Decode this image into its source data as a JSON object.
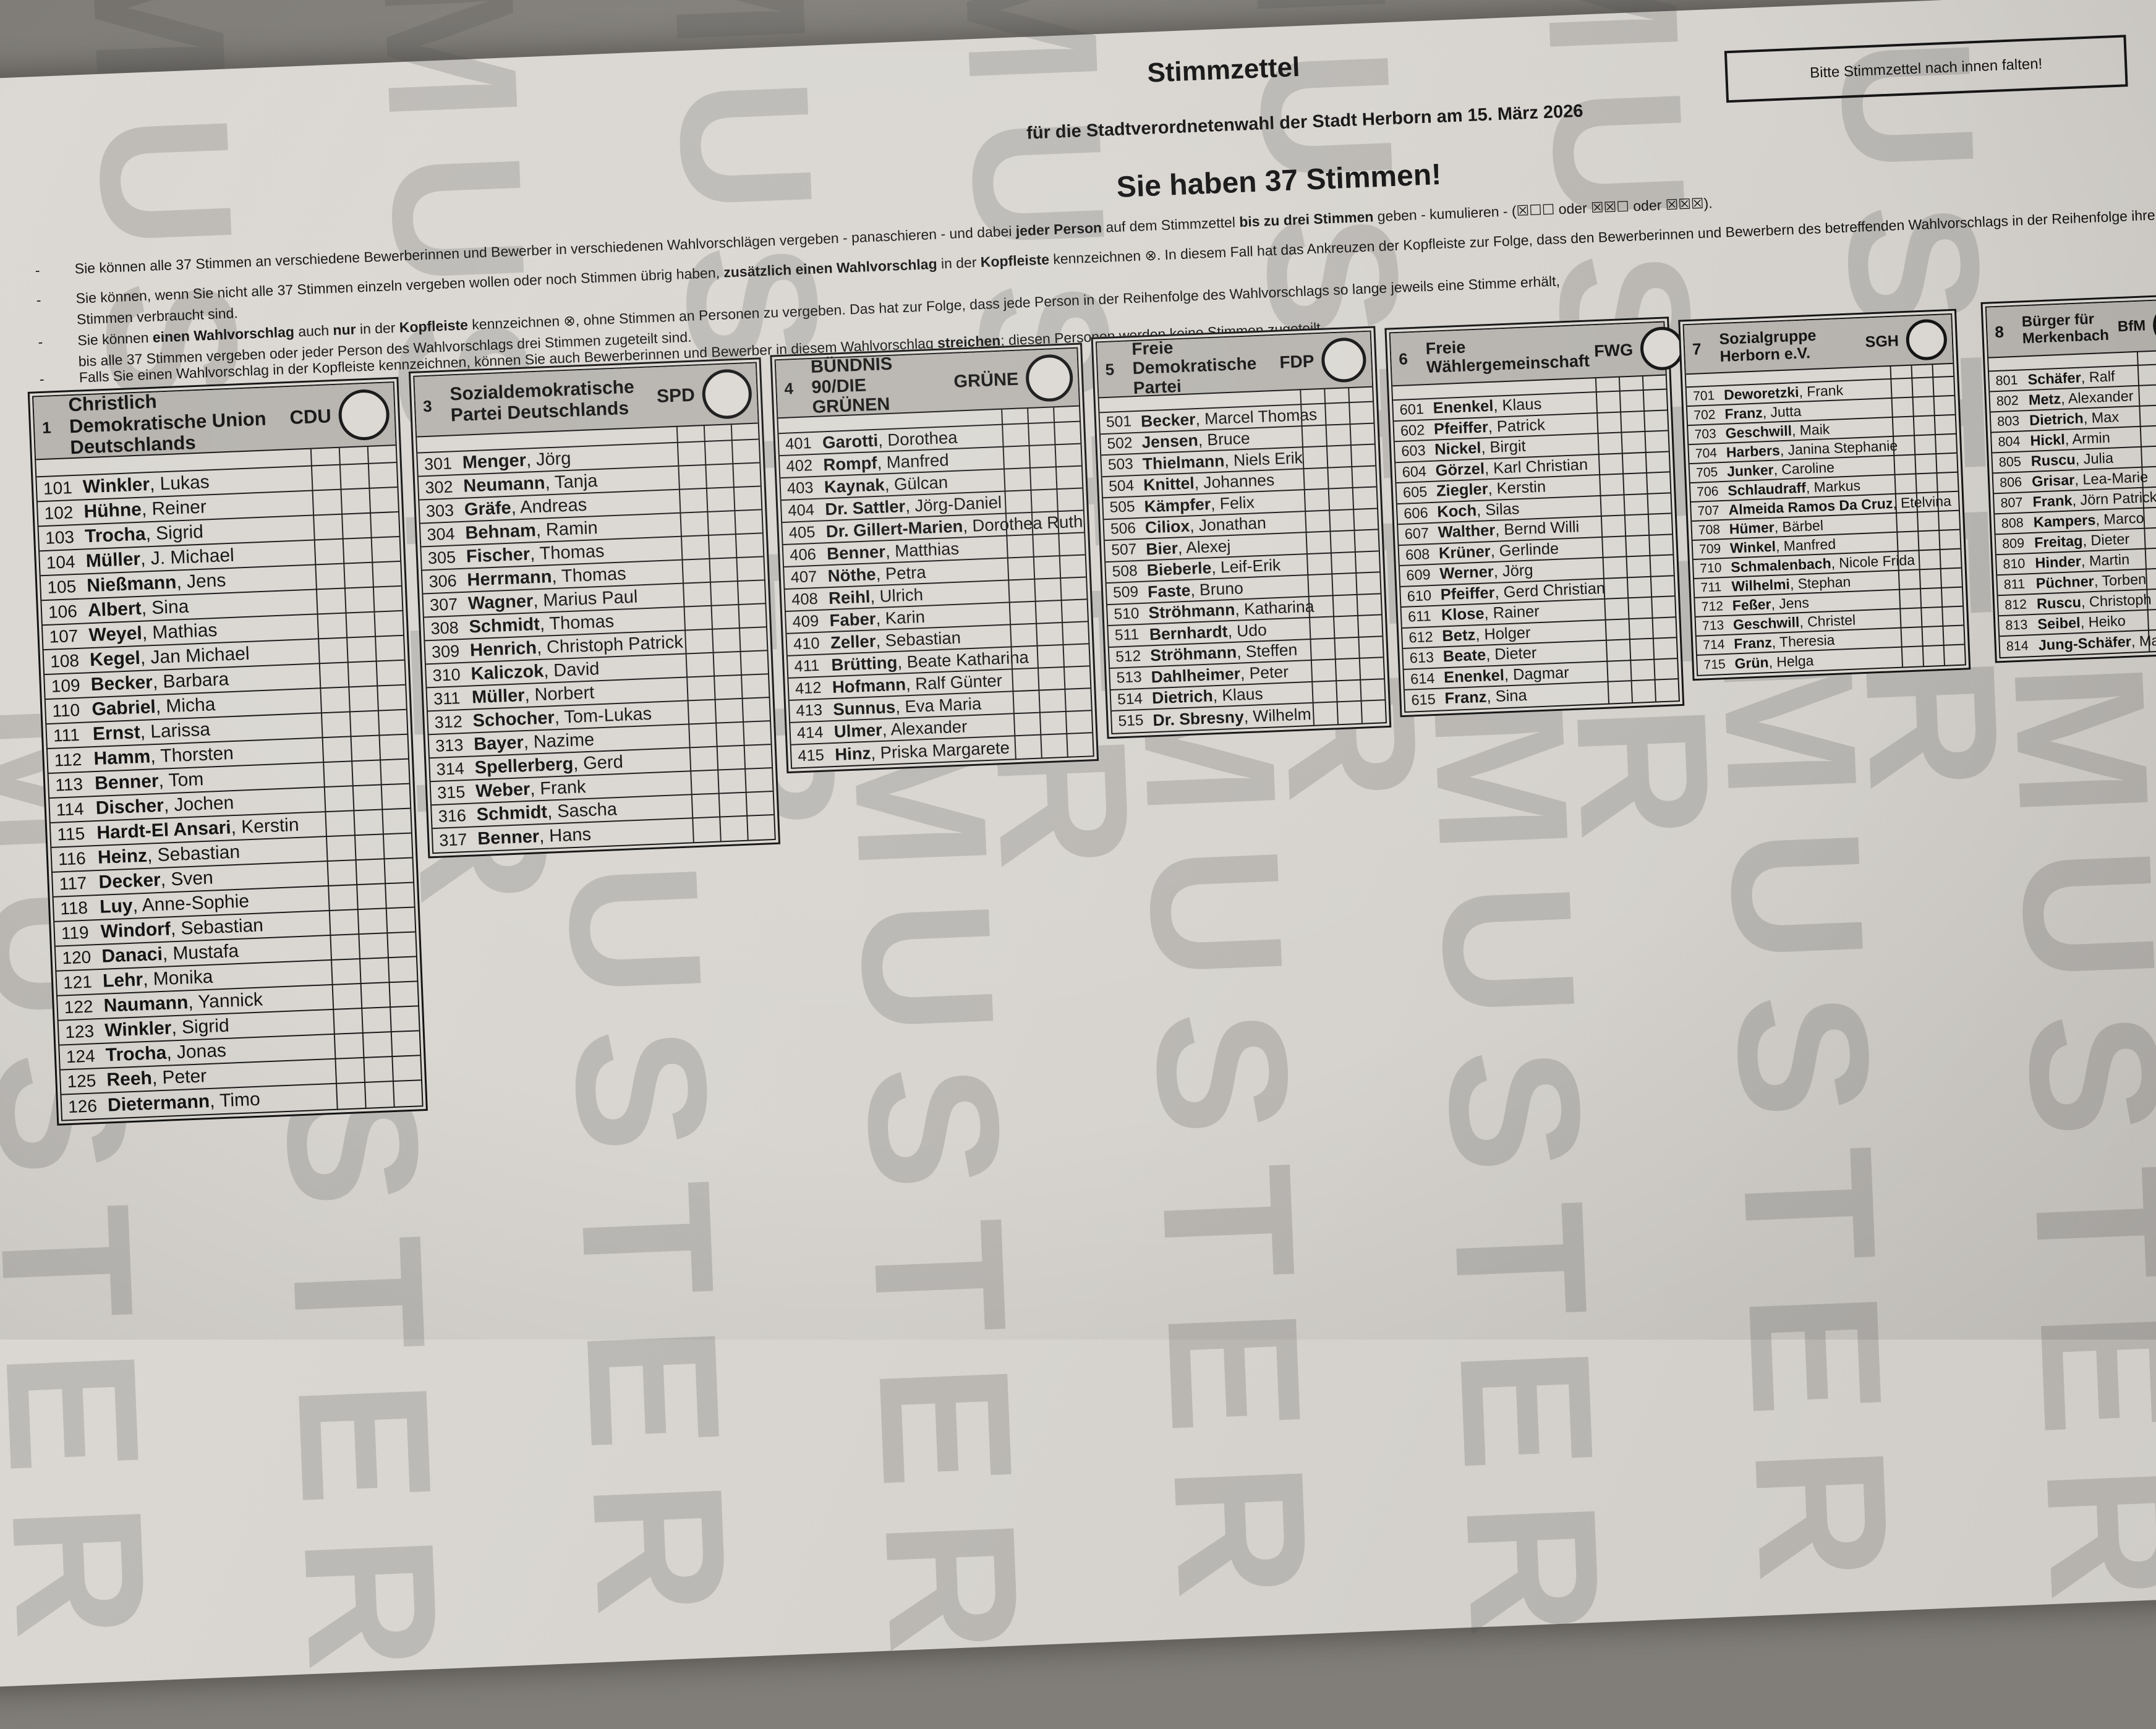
{
  "title": "Stimmzettel",
  "subtitle": "für die Stadtverordnetenwahl der Stadt Herborn am 15. März 2026",
  "votes_headline": "Sie haben 37 Stimmen!",
  "fold_notice": "Bitte Stimmzettel nach innen falten!",
  "watermark": "MUSTER",
  "instructions": [
    [
      {
        "t": "Sie können alle 37 Stimmen an verschiedene Bewerberinnen und Bewerber in verschiedenen Wahlvorschlägen vergeben - panaschieren - und dabei ",
        "b": 0
      },
      {
        "t": "jeder Person",
        "b": 1
      },
      {
        "t": " auf dem Stimmzettel ",
        "b": 0
      },
      {
        "t": "bis zu drei Stimmen",
        "b": 1
      },
      {
        "t": " geben - kumulieren - (☒☐☐ oder ☒☒☐ oder ☒☒☒).",
        "b": 0
      }
    ],
    [
      {
        "t": "Sie können, wenn Sie nicht alle 37 Stimmen einzeln vergeben wollen oder noch Stimmen übrig haben, ",
        "b": 0
      },
      {
        "t": "zusätzlich einen Wahlvorschlag",
        "b": 1
      },
      {
        "t": " in der ",
        "b": 0
      },
      {
        "t": "Kopfleiste",
        "b": 1
      },
      {
        "t": " kennzeichnen ⊗. In diesem Fall hat das Ankreuzen der Kopfleiste zur Folge, dass den Bewerberinnen und Bewerbern des betreffenden Wahlvorschlags in der Reihenfolge ihrer Benennung so lange eine weitere Stimme zugerechnet wird, bis alle\nStimmen verbraucht sind.",
        "b": 0
      }
    ],
    [
      {
        "t": "Sie können ",
        "b": 0
      },
      {
        "t": "einen Wahlvorschlag",
        "b": 1
      },
      {
        "t": " auch ",
        "b": 0
      },
      {
        "t": "nur",
        "b": 1
      },
      {
        "t": " in der ",
        "b": 0
      },
      {
        "t": "Kopfleiste",
        "b": 1
      },
      {
        "t": " kennzeichnen ⊗, ohne Stimmen an Personen zu vergeben. Das hat zur Folge, dass jede Person in der Reihenfolge des Wahlvorschlags so lange jeweils eine Stimme erhält,\nbis alle 37 Stimmen vergeben oder jeder Person des Wahlvorschlags drei Stimmen zugeteilt sind.",
        "b": 0
      }
    ],
    [
      {
        "t": "Falls Sie einen Wahlvorschlag in der Kopfleiste kennzeichnen, können Sie auch Bewerberinnen und Bewerber in diesem Wahlvorschlag ",
        "b": 0
      },
      {
        "t": "streichen",
        "b": 1
      },
      {
        "t": "; diesen Personen werden keine Stimmen zugeteilt.",
        "b": 0
      }
    ]
  ],
  "parties": [
    {
      "number": "1",
      "name": "Christlich Demokratische Union Deutschlands",
      "abbr": "CDU",
      "candidates": [
        {
          "no": "101",
          "last": "Winkler",
          "first": "Lukas"
        },
        {
          "no": "102",
          "last": "Hühne",
          "first": "Reiner"
        },
        {
          "no": "103",
          "last": "Trocha",
          "first": "Sigrid"
        },
        {
          "no": "104",
          "last": "Müller",
          "first": "J. Michael"
        },
        {
          "no": "105",
          "last": "Nießmann",
          "first": "Jens"
        },
        {
          "no": "106",
          "last": "Albert",
          "first": "Sina"
        },
        {
          "no": "107",
          "last": "Weyel",
          "first": "Mathias"
        },
        {
          "no": "108",
          "last": "Kegel",
          "first": "Jan Michael"
        },
        {
          "no": "109",
          "last": "Becker",
          "first": "Barbara"
        },
        {
          "no": "110",
          "last": "Gabriel",
          "first": "Micha"
        },
        {
          "no": "111",
          "last": "Ernst",
          "first": "Larissa"
        },
        {
          "no": "112",
          "last": "Hamm",
          "first": "Thorsten"
        },
        {
          "no": "113",
          "last": "Benner",
          "first": "Tom"
        },
        {
          "no": "114",
          "last": "Discher",
          "first": "Jochen"
        },
        {
          "no": "115",
          "last": "Hardt-El Ansari",
          "first": "Kerstin"
        },
        {
          "no": "116",
          "last": "Heinz",
          "first": "Sebastian"
        },
        {
          "no": "117",
          "last": "Decker",
          "first": "Sven"
        },
        {
          "no": "118",
          "last": "Luy",
          "first": "Anne-Sophie"
        },
        {
          "no": "119",
          "last": "Windorf",
          "first": "Sebastian"
        },
        {
          "no": "120",
          "last": "Danaci",
          "first": "Mustafa"
        },
        {
          "no": "121",
          "last": "Lehr",
          "first": "Monika"
        },
        {
          "no": "122",
          "last": "Naumann",
          "first": "Yannick"
        },
        {
          "no": "123",
          "last": "Winkler",
          "first": "Sigrid"
        },
        {
          "no": "124",
          "last": "Trocha",
          "first": "Jonas"
        },
        {
          "no": "125",
          "last": "Reeh",
          "first": "Peter"
        },
        {
          "no": "126",
          "last": "Dietermann",
          "first": "Timo"
        }
      ]
    },
    {
      "number": "3",
      "name": "Sozialdemokratische Partei Deutschlands",
      "abbr": "SPD",
      "candidates": [
        {
          "no": "301",
          "last": "Menger",
          "first": "Jörg"
        },
        {
          "no": "302",
          "last": "Neumann",
          "first": "Tanja"
        },
        {
          "no": "303",
          "last": "Gräfe",
          "first": "Andreas"
        },
        {
          "no": "304",
          "last": "Behnam",
          "first": "Ramin"
        },
        {
          "no": "305",
          "last": "Fischer",
          "first": "Thomas"
        },
        {
          "no": "306",
          "last": "Herrmann",
          "first": "Thomas"
        },
        {
          "no": "307",
          "last": "Wagner",
          "first": "Marius Paul"
        },
        {
          "no": "308",
          "last": "Schmidt",
          "first": "Thomas"
        },
        {
          "no": "309",
          "last": "Henrich",
          "first": "Christoph Patrick"
        },
        {
          "no": "310",
          "last": "Kaliczok",
          "first": "David"
        },
        {
          "no": "311",
          "last": "Müller",
          "first": "Norbert"
        },
        {
          "no": "312",
          "last": "Schocher",
          "first": "Tom-Lukas"
        },
        {
          "no": "313",
          "last": "Bayer",
          "first": "Nazime"
        },
        {
          "no": "314",
          "last": "Spellerberg",
          "first": "Gerd"
        },
        {
          "no": "315",
          "last": "Weber",
          "first": "Frank"
        },
        {
          "no": "316",
          "last": "Schmidt",
          "first": "Sascha"
        },
        {
          "no": "317",
          "last": "Benner",
          "first": "Hans"
        }
      ]
    },
    {
      "number": "4",
      "name": "BÜNDNIS 90/DIE GRÜNEN",
      "abbr": "GRÜNE",
      "candidates": [
        {
          "no": "401",
          "last": "Garotti",
          "first": "Dorothea"
        },
        {
          "no": "402",
          "last": "Rompf",
          "first": "Manfred"
        },
        {
          "no": "403",
          "last": "Kaynak",
          "first": "Gülcan"
        },
        {
          "no": "404",
          "last": "Dr. Sattler",
          "first": "Jörg-Daniel"
        },
        {
          "no": "405",
          "last": "Dr. Gillert-Marien",
          "first": "Dorothea Ruth"
        },
        {
          "no": "406",
          "last": "Benner",
          "first": "Matthias"
        },
        {
          "no": "407",
          "last": "Nöthe",
          "first": "Petra"
        },
        {
          "no": "408",
          "last": "Reihl",
          "first": "Ulrich"
        },
        {
          "no": "409",
          "last": "Faber",
          "first": "Karin"
        },
        {
          "no": "410",
          "last": "Zeller",
          "first": "Sebastian"
        },
        {
          "no": "411",
          "last": "Brütting",
          "first": "Beate Katharina"
        },
        {
          "no": "412",
          "last": "Hofmann",
          "first": "Ralf Günter"
        },
        {
          "no": "413",
          "last": "Sunnus",
          "first": "Eva Maria"
        },
        {
          "no": "414",
          "last": "Ulmer",
          "first": "Alexander"
        },
        {
          "no": "415",
          "last": "Hinz",
          "first": "Priska Margarete"
        }
      ]
    },
    {
      "number": "5",
      "name": "Freie Demokratische Partei",
      "abbr": "FDP",
      "candidates": [
        {
          "no": "501",
          "last": "Becker",
          "first": "Marcel Thomas"
        },
        {
          "no": "502",
          "last": "Jensen",
          "first": "Bruce"
        },
        {
          "no": "503",
          "last": "Thielmann",
          "first": "Niels Erik"
        },
        {
          "no": "504",
          "last": "Knittel",
          "first": "Johannes"
        },
        {
          "no": "505",
          "last": "Kämpfer",
          "first": "Felix"
        },
        {
          "no": "506",
          "last": "Ciliox",
          "first": "Jonathan"
        },
        {
          "no": "507",
          "last": "Bier",
          "first": "Alexej"
        },
        {
          "no": "508",
          "last": "Bieberle",
          "first": "Leif-Erik"
        },
        {
          "no": "509",
          "last": "Faste",
          "first": "Bruno"
        },
        {
          "no": "510",
          "last": "Ströhmann",
          "first": "Katharina"
        },
        {
          "no": "511",
          "last": "Bernhardt",
          "first": "Udo"
        },
        {
          "no": "512",
          "last": "Ströhmann",
          "first": "Steffen"
        },
        {
          "no": "513",
          "last": "Dahlheimer",
          "first": "Peter"
        },
        {
          "no": "514",
          "last": "Dietrich",
          "first": "Klaus"
        },
        {
          "no": "515",
          "last": "Dr. Sbresny",
          "first": "Wilhelm"
        }
      ]
    },
    {
      "number": "6",
      "name": "Freie Wählergemeinschaft",
      "abbr": "FWG",
      "candidates": [
        {
          "no": "601",
          "last": "Enenkel",
          "first": "Klaus"
        },
        {
          "no": "602",
          "last": "Pfeiffer",
          "first": "Patrick"
        },
        {
          "no": "603",
          "last": "Nickel",
          "first": "Birgit"
        },
        {
          "no": "604",
          "last": "Görzel",
          "first": "Karl Christian"
        },
        {
          "no": "605",
          "last": "Ziegler",
          "first": "Kerstin"
        },
        {
          "no": "606",
          "last": "Koch",
          "first": "Silas"
        },
        {
          "no": "607",
          "last": "Walther",
          "first": "Bernd Willi"
        },
        {
          "no": "608",
          "last": "Krüner",
          "first": "Gerlinde"
        },
        {
          "no": "609",
          "last": "Werner",
          "first": "Jörg"
        },
        {
          "no": "610",
          "last": "Pfeiffer",
          "first": "Gerd Christian"
        },
        {
          "no": "611",
          "last": "Klose",
          "first": "Rainer"
        },
        {
          "no": "612",
          "last": "Betz",
          "first": "Holger"
        },
        {
          "no": "613",
          "last": "Beate",
          "first": "Dieter"
        },
        {
          "no": "614",
          "last": "Enenkel",
          "first": "Dagmar"
        },
        {
          "no": "615",
          "last": "Franz",
          "first": "Sina"
        }
      ]
    },
    {
      "number": "7",
      "name": "Sozialgruppe Herborn e.V.",
      "abbr": "SGH",
      "candidates": [
        {
          "no": "701",
          "last": "Deworetzki",
          "first": "Frank"
        },
        {
          "no": "702",
          "last": "Franz",
          "first": "Jutta"
        },
        {
          "no": "703",
          "last": "Geschwill",
          "first": "Maik"
        },
        {
          "no": "704",
          "last": "Harbers",
          "first": "Janina Stephanie"
        },
        {
          "no": "705",
          "last": "Junker",
          "first": "Caroline"
        },
        {
          "no": "706",
          "last": "Schlaudraff",
          "first": "Markus"
        },
        {
          "no": "707",
          "last": "Almeida Ramos Da Cruz",
          "first": "Etelvina"
        },
        {
          "no": "708",
          "last": "Hümer",
          "first": "Bärbel"
        },
        {
          "no": "709",
          "last": "Winkel",
          "first": "Manfred"
        },
        {
          "no": "710",
          "last": "Schmalenbach",
          "first": "Nicole Frida"
        },
        {
          "no": "711",
          "last": "Wilhelmi",
          "first": "Stephan"
        },
        {
          "no": "712",
          "last": "Feßer",
          "first": "Jens"
        },
        {
          "no": "713",
          "last": "Geschwill",
          "first": "Christel"
        },
        {
          "no": "714",
          "last": "Franz",
          "first": "Theresia"
        },
        {
          "no": "715",
          "last": "Grün",
          "first": "Helga"
        }
      ]
    },
    {
      "number": "8",
      "name": "Bürger für Merkenbach",
      "abbr": "BfM",
      "candidates": [
        {
          "no": "801",
          "last": "Schäfer",
          "first": "Ralf"
        },
        {
          "no": "802",
          "last": "Metz",
          "first": "Alexander"
        },
        {
          "no": "803",
          "last": "Dietrich",
          "first": "Max"
        },
        {
          "no": "804",
          "last": "Hickl",
          "first": "Armin"
        },
        {
          "no": "805",
          "last": "Ruscu",
          "first": "Julia"
        },
        {
          "no": "806",
          "last": "Grisar",
          "first": "Lea-Marie"
        },
        {
          "no": "807",
          "last": "Frank",
          "first": "Jörn Patrick"
        },
        {
          "no": "808",
          "last": "Kampers",
          "first": "Marco"
        },
        {
          "no": "809",
          "last": "Freitag",
          "first": "Dieter"
        },
        {
          "no": "810",
          "last": "Hinder",
          "first": "Martin"
        },
        {
          "no": "811",
          "last": "Püchner",
          "first": "Torben"
        },
        {
          "no": "812",
          "last": "Ruscu",
          "first": "Christoph"
        },
        {
          "no": "813",
          "last": "Seibel",
          "first": "Heiko"
        },
        {
          "no": "814",
          "last": "Jung-Schäfer",
          "first": "Martina"
        }
      ]
    }
  ]
}
